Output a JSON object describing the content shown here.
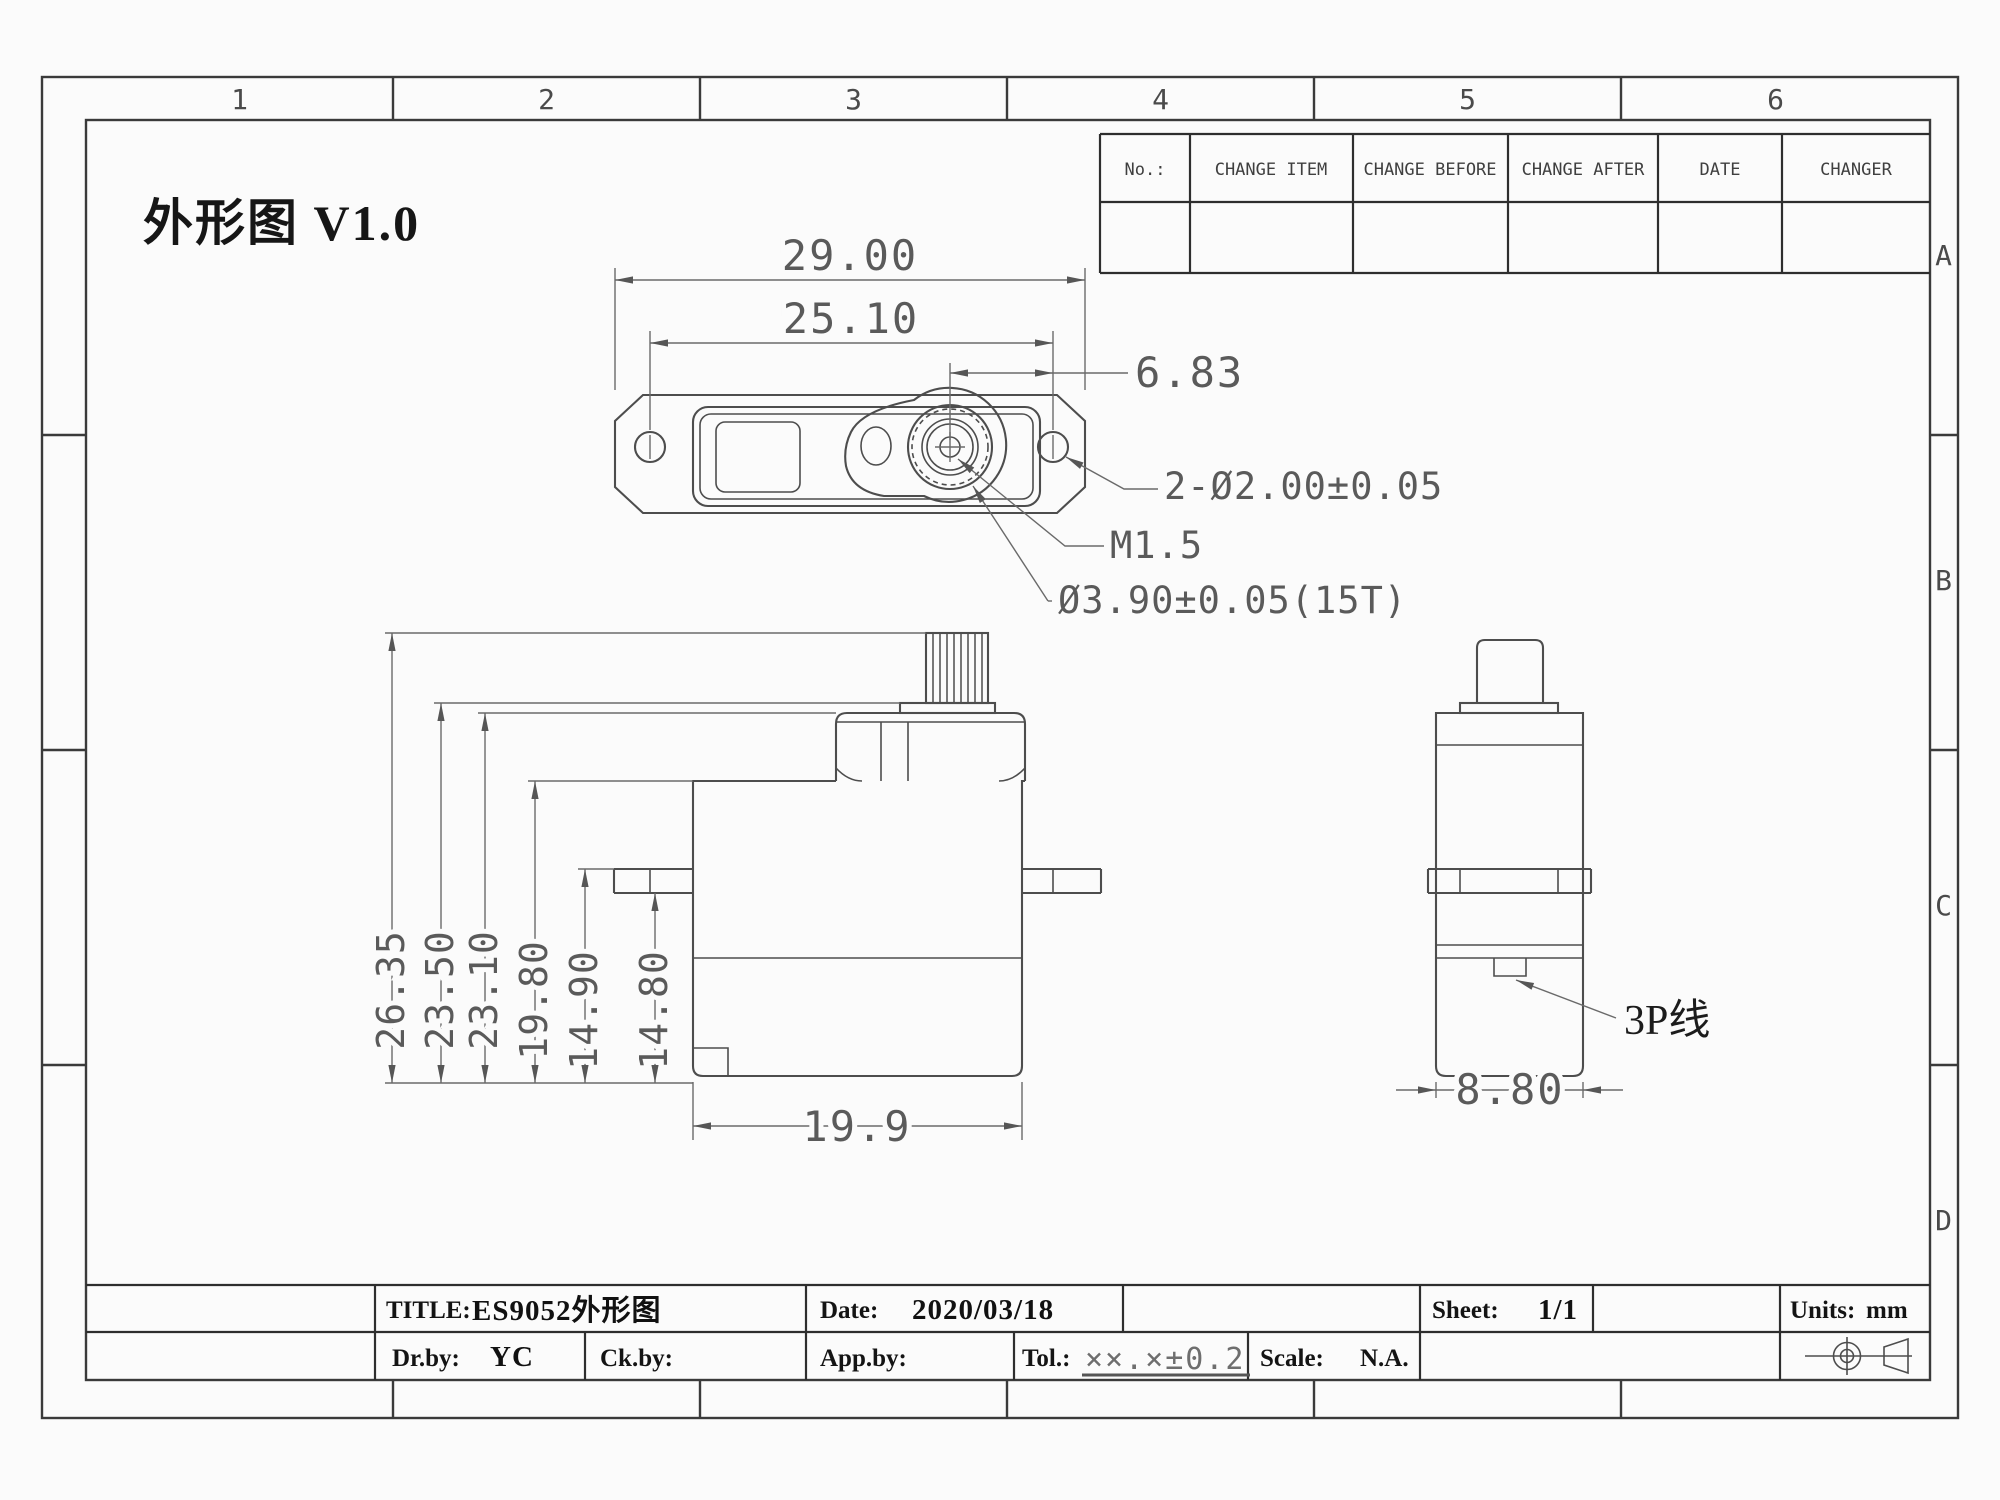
{
  "sheet": {
    "drawing_title": "外形图 V1.0",
    "zone_columns": [
      "1",
      "2",
      "3",
      "4",
      "5",
      "6"
    ],
    "zone_rows": [
      "A",
      "B",
      "C",
      "D"
    ]
  },
  "change_table": {
    "headers": [
      "No.:",
      "CHANGE ITEM",
      "CHANGE BEFORE",
      "CHANGE AFTER",
      "DATE",
      "CHANGER"
    ]
  },
  "views": {
    "top": {
      "dim_overall_width": "29.00",
      "dim_mount_hole_spacing": "25.10",
      "dim_shaft_to_hole": "6.83",
      "label_mount_holes": "2-Ø2.00±0.05",
      "label_screw_thread": "M1.5",
      "label_spline_dia": "Ø3.90±0.05(15T)"
    },
    "front": {
      "dim_total_height": "26.35",
      "dim_upper_case_height": "23.50",
      "dim_case_step_height": "23.10",
      "dim_body_top_height": "19.80",
      "dim_flange_top_height": "14.90",
      "dim_flange_bottom_height": "14.80",
      "dim_body_length": "19.9"
    },
    "side": {
      "dim_body_width": "8.80",
      "label_connector_wire": "3P线"
    }
  },
  "title_block": {
    "title_label": "TITLE:",
    "title_value": "ES9052外形图",
    "date_label": "Date:",
    "date_value": "2020/03/18",
    "sheet_label": "Sheet:",
    "sheet_value": "1/1",
    "units_label": "Units:",
    "units_value": "mm",
    "drby_label": "Dr.by:",
    "drby_value": "YC",
    "ckby_label": "Ck.by:",
    "appby_label": "App.by:",
    "tol_label": "Tol.:",
    "tol_value": "××.×±0.2",
    "scale_label": "Scale:",
    "scale_value": "N.A."
  }
}
